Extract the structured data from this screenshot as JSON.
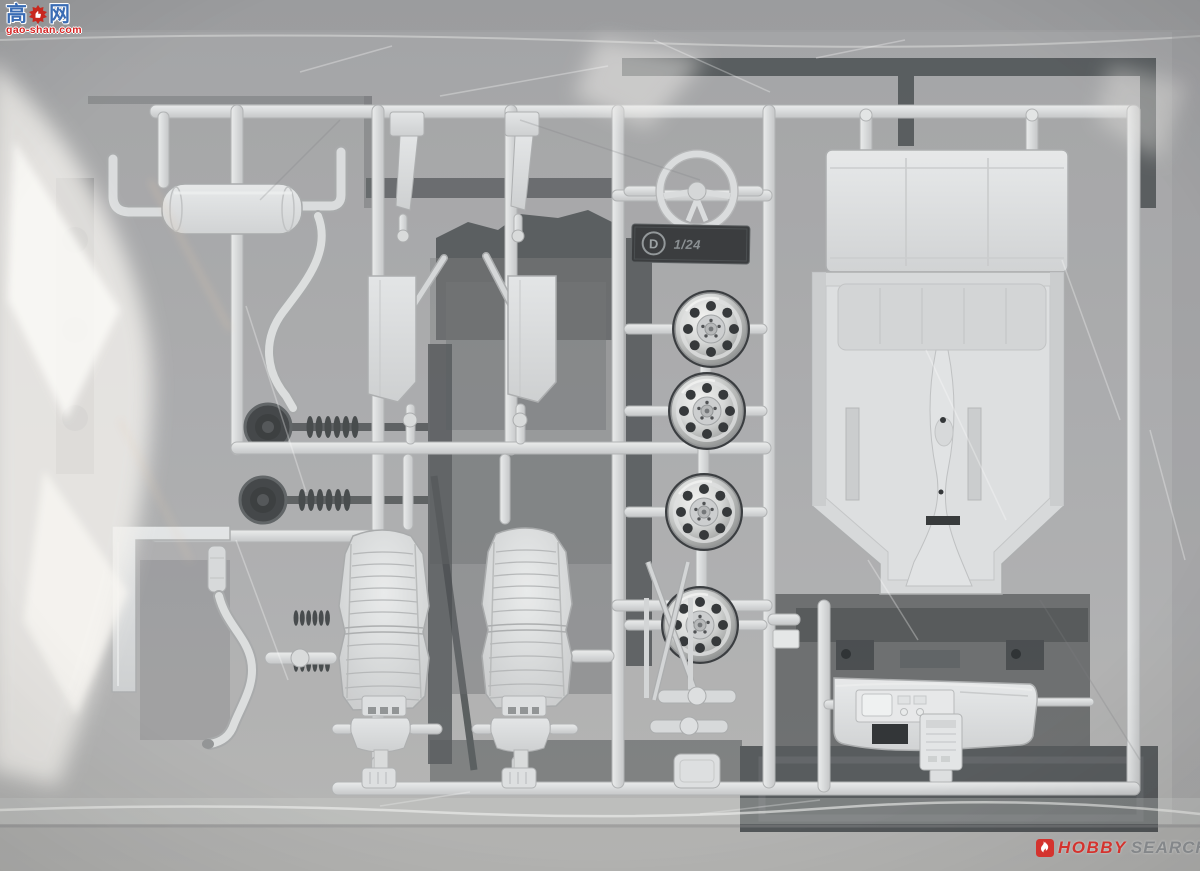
{
  "watermarks": {
    "top_left": {
      "char_left": "高",
      "char_right": "网",
      "domain": "gao-shan.com",
      "char_color": "#3a6cb4",
      "domain_color": "#d42222",
      "gear_color": "#c8281e"
    },
    "bottom_right": {
      "word_primary": "HOBBY",
      "word_secondary": "SEARCH",
      "primary_color": "#d4332e",
      "secondary_color": "#84878a",
      "icon_color": "#d4332e"
    }
  },
  "sprue_tag": {
    "letter": "D",
    "scale_text": "1/24"
  },
  "colors": {
    "background": "#a4a5a7",
    "bag_highlight": "#f3f1ed",
    "white_plastic": "#d9dbdc",
    "dark_plastic": "#4a4e50",
    "chrome": "#c9cbca"
  }
}
